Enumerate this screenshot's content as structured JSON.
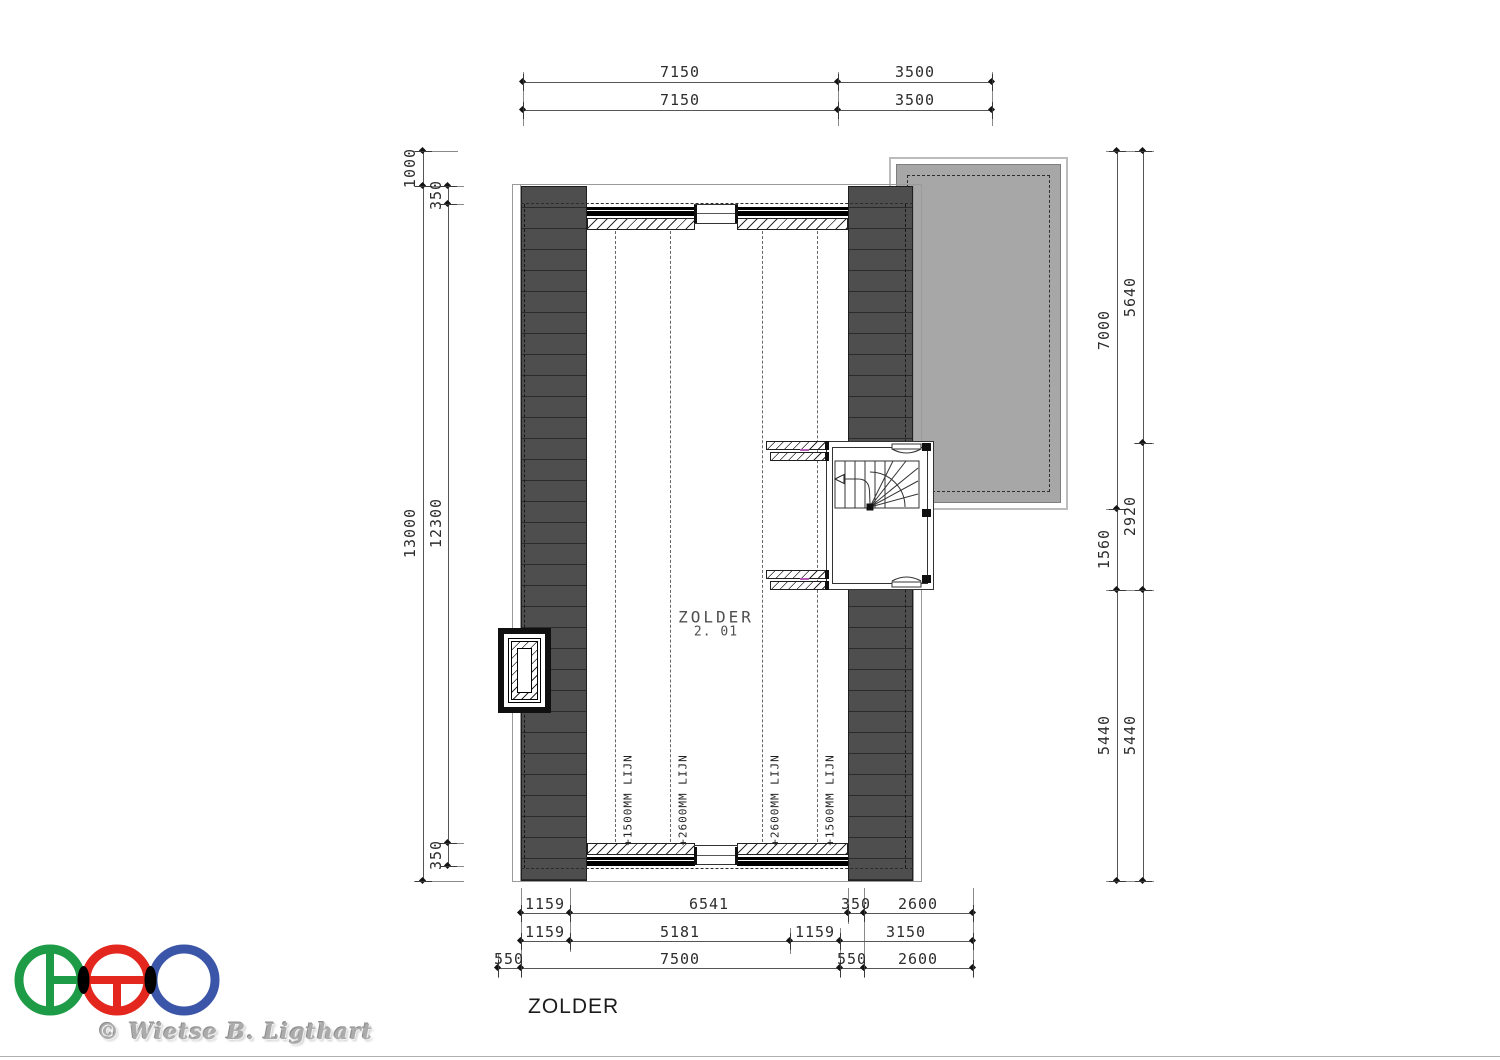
{
  "sheet": {
    "title": "ZOLDER"
  },
  "room": {
    "name": "ZOLDER",
    "number": "2. 01"
  },
  "copyright": "© Wietse B. Ligthart",
  "height_lines": [
    "+1500MM LIJN",
    "+2600MM LIJN",
    "+2600MM LIJN",
    "+1500MM LIJN"
  ],
  "dims": {
    "top_row1": [
      "7150",
      "3500"
    ],
    "top_row2": [
      "7150",
      "3500"
    ],
    "bottom_row1": [
      "1159",
      "6541",
      "350",
      "2600"
    ],
    "bottom_row2": [
      "1159",
      "5181",
      "1159",
      "3150"
    ],
    "bottom_row3": [
      "550",
      "7500",
      "550",
      "2600"
    ],
    "left_outer": [
      "1000",
      "13000"
    ],
    "left_inner": [
      "350",
      "12300",
      "350"
    ],
    "right_inner": [
      "7000",
      "1560",
      "5440"
    ],
    "right_outer": [
      "5640",
      "2920",
      "5440"
    ]
  },
  "colors": {
    "roof_fill": "#4e4e4e",
    "balcony_fill": "#a7a7a7",
    "logo_green": "#1d9b47",
    "logo_red": "#e3271e",
    "logo_blue": "#3b55a8",
    "marker_magenta": "#b55ab5"
  }
}
